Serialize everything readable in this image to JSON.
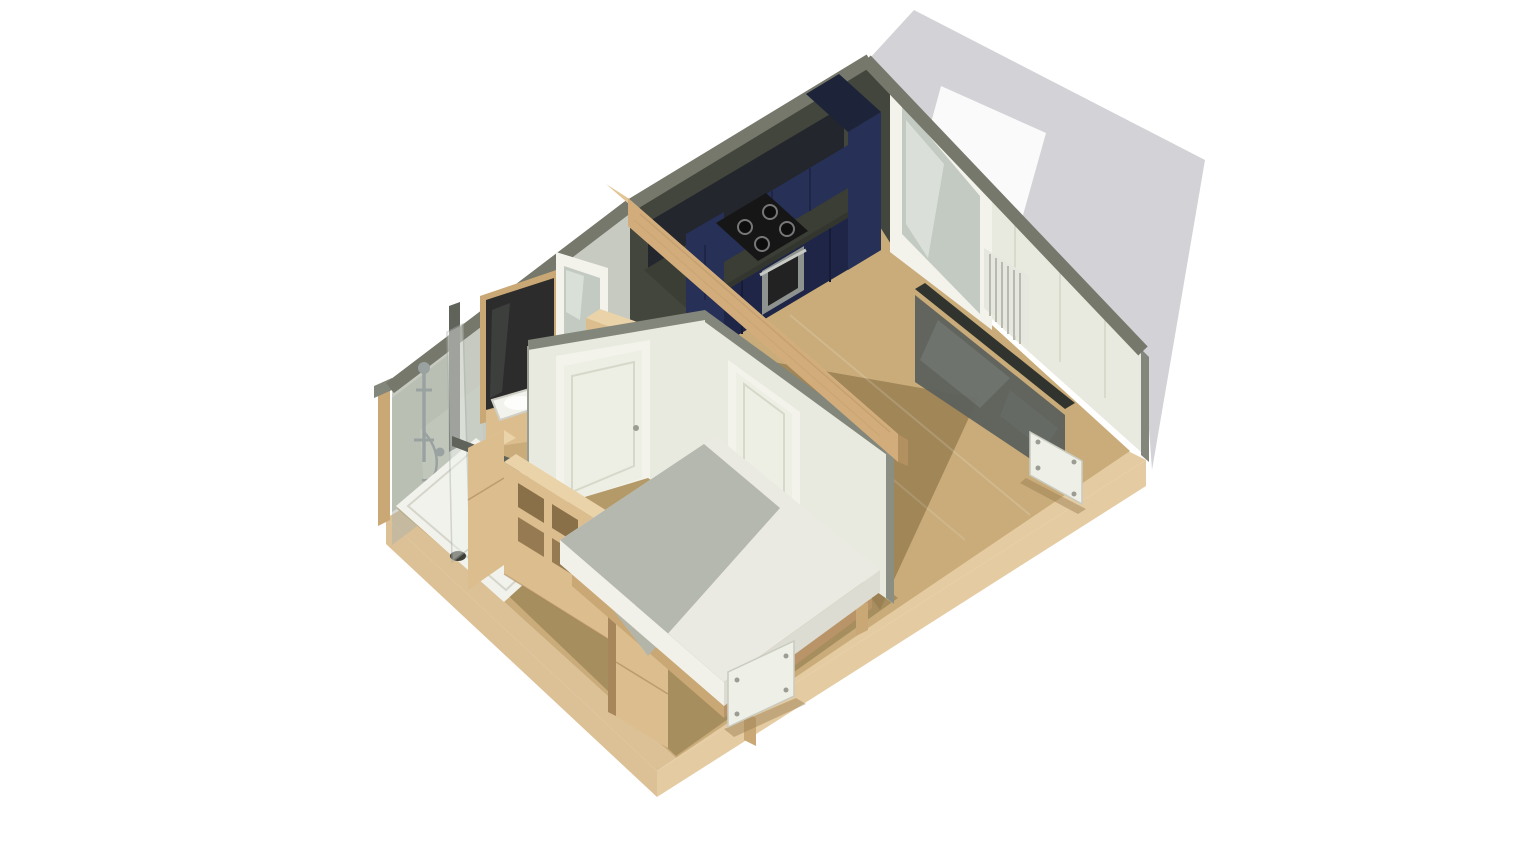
{
  "scene": {
    "title": "Axonometric cutaway 3D render of a small studio apartment",
    "view": "isometric cutaway from above, white background with cast shadow",
    "rooms_count": "4"
  },
  "colors": {
    "bg": "#ffffff",
    "shadow": "#d3d3d7",
    "shadowLight": "#fafafb",
    "capGray": "#75786b",
    "capGrayDark": "#60635a",
    "plaster": "#c6cac1",
    "plasterShade": "#aeb3a8",
    "stoneDark": "#43463c",
    "stoneLight": "#585c4f",
    "splashDark": "#23262c",
    "wallWhite": "#e9eadf",
    "wallWhiteShade": "#dcded2",
    "doorWhite": "#f3f3ec",
    "doorPanel": "#edeee4",
    "woodLight": "#dcbd8e",
    "woodMid": "#caa876",
    "woodDark": "#a8865c",
    "woodTop": "#ead3a9",
    "cubbyDark": "#8a7048",
    "floorTan": "#c9ac79",
    "floorShadow": "#977d50",
    "floorBedroom": "#a78e5e",
    "floorBath": "#c3a671",
    "platformEdge": "#e5cba1",
    "platformEdgeDark": "#dcc096",
    "navy": "#273056",
    "navyDark": "#1e2546",
    "navyTop": "#1d2338",
    "counterDark": "#33362e",
    "counterTop": "#3a3e35",
    "hobBlack": "#161616",
    "steel": "#8e938f",
    "glassGray": "#5b605c",
    "glassLight": "#c2cac1",
    "chrome": "#9aa2a1",
    "matWhite": "#eaeae2",
    "matShadow": "#b2b5ac",
    "matSideLight": "#f1f1e9",
    "matSideDark": "#dddcd2",
    "radiator": "#e6e7df",
    "radiatorFin": "#b8bab0",
    "panelWhite": "#eef0e8",
    "screwGray": "#9b9d92",
    "trimGray": "#83867a",
    "mirrorDark": "#2c2c2c"
  },
  "rooms": {
    "kitchen": {
      "label": "Kitchen",
      "items": [
        "navy cabinet run",
        "tall navy columns",
        "dark stone backsplash",
        "gas hob with four burners",
        "stainless oven",
        "window with white frame"
      ]
    },
    "living_room": {
      "label": "Living room",
      "items": [
        "glazed white wall panels",
        "wall radiator",
        "dark glass room divider",
        "white heater panel"
      ]
    },
    "bedroom": {
      "label": "Bedroom",
      "items": [
        "double bed with white mattress",
        "oak shelving headboard with cubbies",
        "two white panel doors",
        "white heater panel"
      ]
    },
    "bathroom": {
      "label": "Bathroom",
      "items": [
        "white shower tray",
        "glass shower screen",
        "chrome shower column",
        "mirror cabinet",
        "washbasin",
        "oak vanity",
        "small window",
        "oak cabinet under window"
      ]
    }
  },
  "structure": {
    "platform": "light oak base platform with beveled edge",
    "walls": "gray parapet caps, plaster and white glazed faces",
    "partition_beam": "exposed oak beam on interior partition"
  }
}
